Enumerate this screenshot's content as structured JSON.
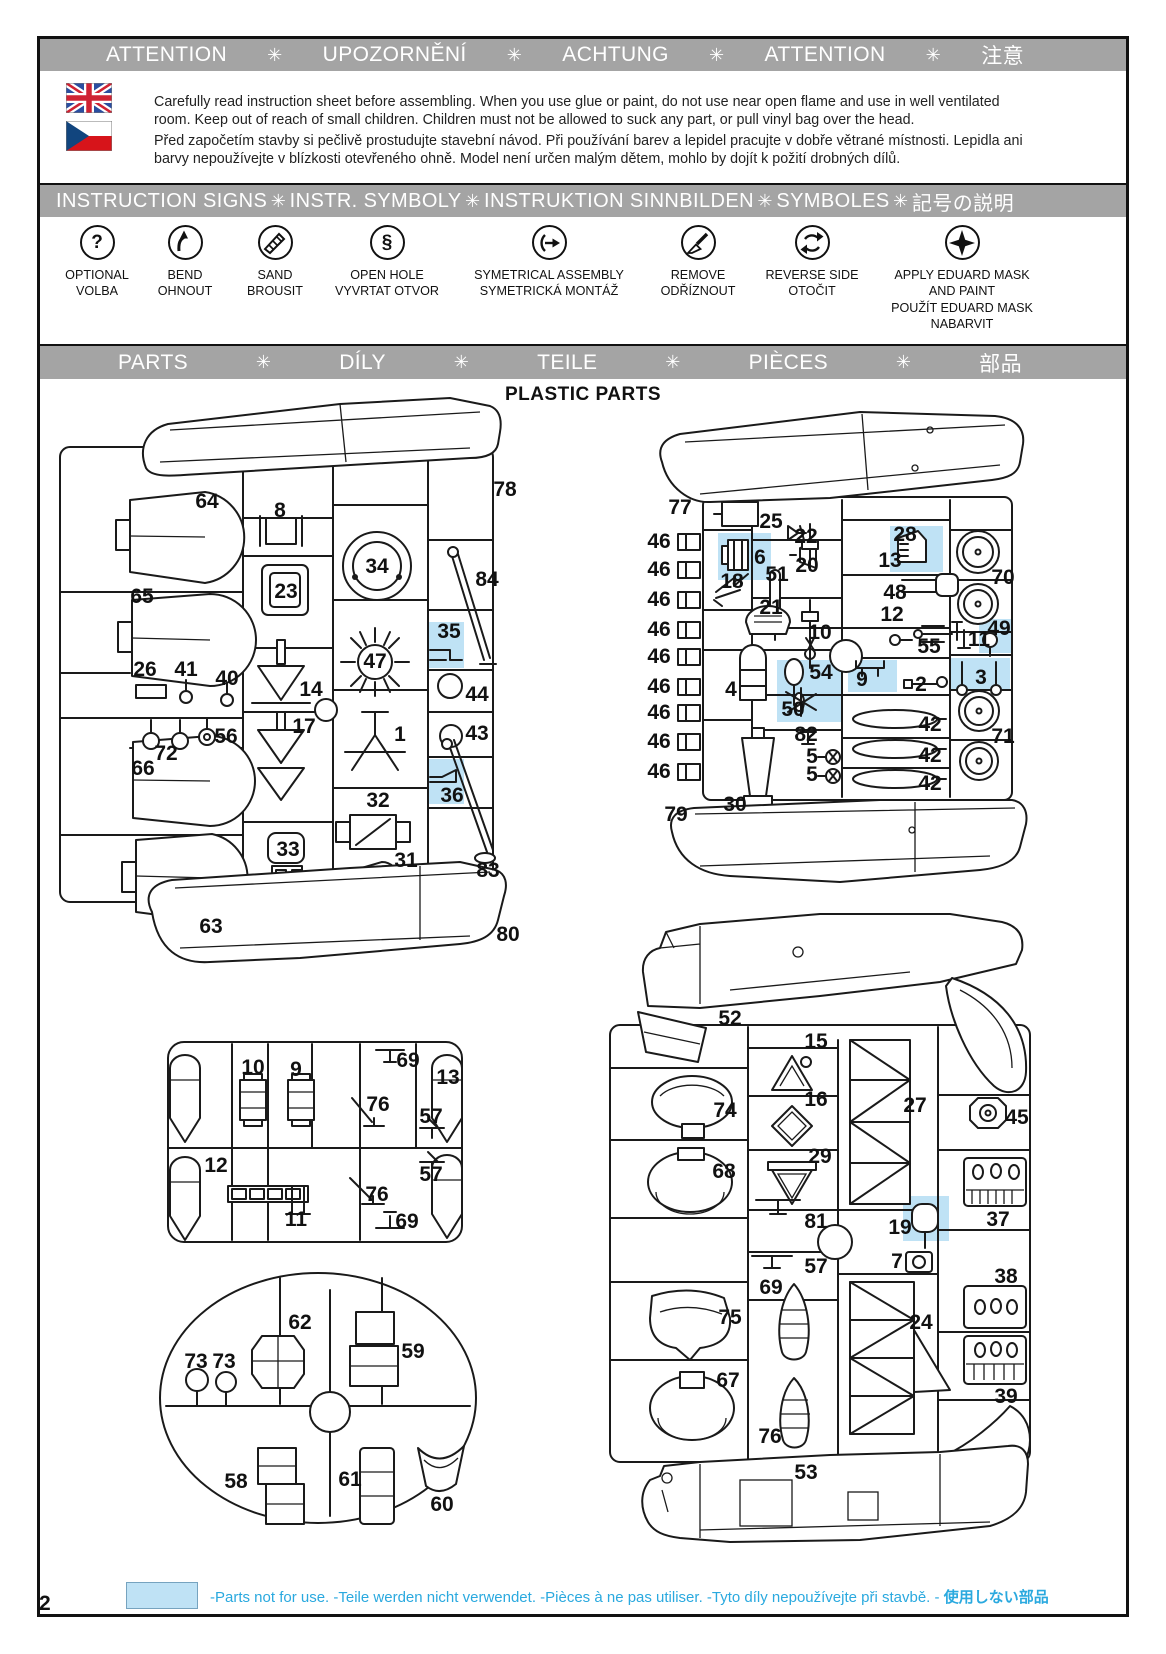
{
  "page": {
    "number": "2",
    "title": "PLASTIC PARTS"
  },
  "colors": {
    "banner_gray": "#a4a4a4",
    "highlight_blue": "#bfe2f5",
    "legend_cyan": "#2aa9df",
    "ink": "#1a1a1a"
  },
  "banner_separator": "✳",
  "banners": {
    "attention": [
      "ATTENTION",
      "UPOZORNĚNÍ",
      "ACHTUNG",
      "ATTENTION",
      "注意"
    ],
    "signs": [
      "INSTRUCTION SIGNS",
      "INSTR. SYMBOLY",
      "INSTRUKTION  SINNBILDEN",
      "SYMBOLES",
      "記号の説明"
    ],
    "parts": [
      "PARTS",
      "DÍLY",
      "TEILE",
      "PIÈCES",
      "部品"
    ]
  },
  "attention_text": {
    "english": "Carefully read instruction sheet before assembling. When you use glue or paint, do not use near open flame and use in well ventilated room. Keep out of reach of small children. Children must not be allowed to suck any part, or pull vinyl bag over the head.",
    "czech": "Před započetím stavby si pečlivě prostudujte stavební návod. Při používání barev a lepidel pracujte v dobře větrané místnosti. Lepidla ani barvy nepoužívejte v blízkosti otevřeného ohně. Model není určen malým dětem, mohlo by dojít k požití drobných dílů."
  },
  "signs": [
    {
      "icon": "optional-question-icon",
      "lines": [
        "OPTIONAL",
        "VOLBA"
      ]
    },
    {
      "icon": "bend-arrow-icon",
      "lines": [
        "BEND",
        "OHNOUT"
      ]
    },
    {
      "icon": "sand-icon",
      "lines": [
        "SAND",
        "BROUSIT"
      ]
    },
    {
      "icon": "open-hole-drill-icon",
      "lines": [
        "OPEN HOLE",
        "VYVRTAT OTVOR"
      ]
    },
    {
      "icon": "symmetrical-assembly-icon",
      "lines": [
        "SYMETRICAL ASSEMBLY",
        "SYMETRICKÁ MONTÁŽ"
      ]
    },
    {
      "icon": "remove-knife-icon",
      "lines": [
        "REMOVE",
        "ODŘÍZNOUT"
      ]
    },
    {
      "icon": "reverse-side-icon",
      "lines": [
        "REVERSE SIDE",
        "OTOČIT"
      ]
    },
    {
      "icon": "eduard-mask-icon",
      "lines": [
        "APPLY EDUARD MASK",
        "AND PAINT",
        "POUŽÍT EDUARD MASK",
        "NABARVIT"
      ]
    }
  ],
  "legend": {
    "text": "-Parts not for use. -Teile werden nicht verwendet. -Pièces à ne pas utiliser. -Tyto díly nepoužívejte při stavbě. -",
    "text_jp": "使用しない部品"
  },
  "sprues": {
    "A": {
      "labels": [
        {
          "n": "64",
          "x": 207,
          "y": 502
        },
        {
          "n": "8",
          "x": 280,
          "y": 511
        },
        {
          "n": "78",
          "x": 505,
          "y": 490
        },
        {
          "n": "34",
          "x": 377,
          "y": 567
        },
        {
          "n": "23",
          "x": 286,
          "y": 592
        },
        {
          "n": "65",
          "x": 142,
          "y": 597
        },
        {
          "n": "84",
          "x": 487,
          "y": 580
        },
        {
          "n": "35",
          "x": 449,
          "y": 632,
          "hl": true
        },
        {
          "n": "26",
          "x": 145,
          "y": 670
        },
        {
          "n": "41",
          "x": 186,
          "y": 670
        },
        {
          "n": "40",
          "x": 227,
          "y": 679
        },
        {
          "n": "14",
          "x": 311,
          "y": 690
        },
        {
          "n": "47",
          "x": 375,
          "y": 662
        },
        {
          "n": "44",
          "x": 477,
          "y": 695
        },
        {
          "n": "17",
          "x": 304,
          "y": 727
        },
        {
          "n": "1",
          "x": 400,
          "y": 735
        },
        {
          "n": "43",
          "x": 477,
          "y": 734
        },
        {
          "n": "56",
          "x": 226,
          "y": 737
        },
        {
          "n": "72",
          "x": 166,
          "y": 754
        },
        {
          "n": "66",
          "x": 143,
          "y": 769
        },
        {
          "n": "36",
          "x": 452,
          "y": 796,
          "hl": true
        },
        {
          "n": "32",
          "x": 378,
          "y": 801
        },
        {
          "n": "33",
          "x": 288,
          "y": 850
        },
        {
          "n": "31",
          "x": 406,
          "y": 861
        },
        {
          "n": "83",
          "x": 488,
          "y": 871
        },
        {
          "n": "63",
          "x": 211,
          "y": 927
        },
        {
          "n": "80",
          "x": 508,
          "y": 935
        }
      ]
    },
    "B": {
      "labels": [
        {
          "n": "77",
          "x": 680,
          "y": 508
        },
        {
          "n": "25",
          "x": 771,
          "y": 522
        },
        {
          "n": "22",
          "x": 806,
          "y": 537
        },
        {
          "n": "28",
          "x": 905,
          "y": 535,
          "hl": true
        },
        {
          "n": "46",
          "x": 659,
          "y": 542
        },
        {
          "n": "46",
          "x": 659,
          "y": 570
        },
        {
          "n": "46",
          "x": 659,
          "y": 600
        },
        {
          "n": "46",
          "x": 659,
          "y": 630
        },
        {
          "n": "46",
          "x": 659,
          "y": 657
        },
        {
          "n": "46",
          "x": 659,
          "y": 687
        },
        {
          "n": "46",
          "x": 659,
          "y": 713
        },
        {
          "n": "46",
          "x": 659,
          "y": 742
        },
        {
          "n": "46",
          "x": 659,
          "y": 772
        },
        {
          "n": "6",
          "x": 760,
          "y": 558,
          "hl": true
        },
        {
          "n": "18",
          "x": 732,
          "y": 582
        },
        {
          "n": "51",
          "x": 777,
          "y": 575
        },
        {
          "n": "20",
          "x": 807,
          "y": 566
        },
        {
          "n": "13",
          "x": 890,
          "y": 561
        },
        {
          "n": "48",
          "x": 895,
          "y": 593
        },
        {
          "n": "12",
          "x": 892,
          "y": 615
        },
        {
          "n": "70",
          "x": 1003,
          "y": 578
        },
        {
          "n": "21",
          "x": 771,
          "y": 608
        },
        {
          "n": "10",
          "x": 820,
          "y": 633
        },
        {
          "n": "55",
          "x": 929,
          "y": 647
        },
        {
          "n": "49",
          "x": 999,
          "y": 629,
          "hl": true
        },
        {
          "n": "11",
          "x": 979,
          "y": 640
        },
        {
          "n": "4",
          "x": 731,
          "y": 690
        },
        {
          "n": "54",
          "x": 821,
          "y": 673,
          "hl": true
        },
        {
          "n": "50",
          "x": 793,
          "y": 710,
          "hl": true
        },
        {
          "n": "9",
          "x": 862,
          "y": 680,
          "hl": true
        },
        {
          "n": "2",
          "x": 921,
          "y": 685
        },
        {
          "n": "3",
          "x": 981,
          "y": 678,
          "hl": true
        },
        {
          "n": "42",
          "x": 930,
          "y": 725
        },
        {
          "n": "42",
          "x": 930,
          "y": 756
        },
        {
          "n": "42",
          "x": 930,
          "y": 784
        },
        {
          "n": "71",
          "x": 1003,
          "y": 737
        },
        {
          "n": "82",
          "x": 806,
          "y": 735
        },
        {
          "n": "5",
          "x": 812,
          "y": 757
        },
        {
          "n": "5",
          "x": 812,
          "y": 775
        },
        {
          "n": "30",
          "x": 735,
          "y": 805
        },
        {
          "n": "79",
          "x": 676,
          "y": 815
        }
      ]
    },
    "C": {
      "labels": [
        {
          "n": "10",
          "x": 253,
          "y": 1068
        },
        {
          "n": "9",
          "x": 296,
          "y": 1070
        },
        {
          "n": "69",
          "x": 408,
          "y": 1061
        },
        {
          "n": "13",
          "x": 448,
          "y": 1078
        },
        {
          "n": "76",
          "x": 378,
          "y": 1105
        },
        {
          "n": "57",
          "x": 431,
          "y": 1117
        },
        {
          "n": "12",
          "x": 216,
          "y": 1166
        },
        {
          "n": "57",
          "x": 431,
          "y": 1175
        },
        {
          "n": "76",
          "x": 377,
          "y": 1195
        },
        {
          "n": "11",
          "x": 296,
          "y": 1220
        },
        {
          "n": "69",
          "x": 407,
          "y": 1222
        }
      ]
    },
    "D": {
      "labels": [
        {
          "n": "62",
          "x": 300,
          "y": 1323
        },
        {
          "n": "59",
          "x": 413,
          "y": 1352
        },
        {
          "n": "73",
          "x": 196,
          "y": 1362
        },
        {
          "n": "73",
          "x": 224,
          "y": 1362
        },
        {
          "n": "58",
          "x": 236,
          "y": 1482
        },
        {
          "n": "61",
          "x": 350,
          "y": 1480
        },
        {
          "n": "60",
          "x": 442,
          "y": 1505
        }
      ]
    },
    "E": {
      "labels": [
        {
          "n": "52",
          "x": 730,
          "y": 1019
        },
        {
          "n": "15",
          "x": 816,
          "y": 1042
        },
        {
          "n": "74",
          "x": 725,
          "y": 1111
        },
        {
          "n": "16",
          "x": 816,
          "y": 1100
        },
        {
          "n": "27",
          "x": 915,
          "y": 1106
        },
        {
          "n": "45",
          "x": 1017,
          "y": 1118
        },
        {
          "n": "29",
          "x": 820,
          "y": 1157
        },
        {
          "n": "68",
          "x": 724,
          "y": 1172
        },
        {
          "n": "37",
          "x": 998,
          "y": 1220
        },
        {
          "n": "81",
          "x": 816,
          "y": 1222
        },
        {
          "n": "19",
          "x": 900,
          "y": 1228,
          "hl": true
        },
        {
          "n": "57",
          "x": 816,
          "y": 1267
        },
        {
          "n": "7",
          "x": 897,
          "y": 1262
        },
        {
          "n": "69",
          "x": 771,
          "y": 1288
        },
        {
          "n": "38",
          "x": 1006,
          "y": 1277
        },
        {
          "n": "75",
          "x": 730,
          "y": 1318
        },
        {
          "n": "24",
          "x": 921,
          "y": 1323
        },
        {
          "n": "67",
          "x": 728,
          "y": 1381
        },
        {
          "n": "39",
          "x": 1006,
          "y": 1397
        },
        {
          "n": "76",
          "x": 770,
          "y": 1437
        },
        {
          "n": "53",
          "x": 806,
          "y": 1473
        }
      ]
    }
  },
  "highlight_boxes": [
    [
      427,
      622,
      37,
      46
    ],
    [
      427,
      759,
      37,
      45
    ],
    [
      718,
      533,
      53,
      47
    ],
    [
      890,
      526,
      53,
      46
    ],
    [
      979,
      619,
      33,
      34
    ],
    [
      777,
      660,
      65,
      62
    ],
    [
      848,
      660,
      49,
      32
    ],
    [
      950,
      658,
      60,
      33
    ],
    [
      903,
      1196,
      46,
      45
    ]
  ]
}
